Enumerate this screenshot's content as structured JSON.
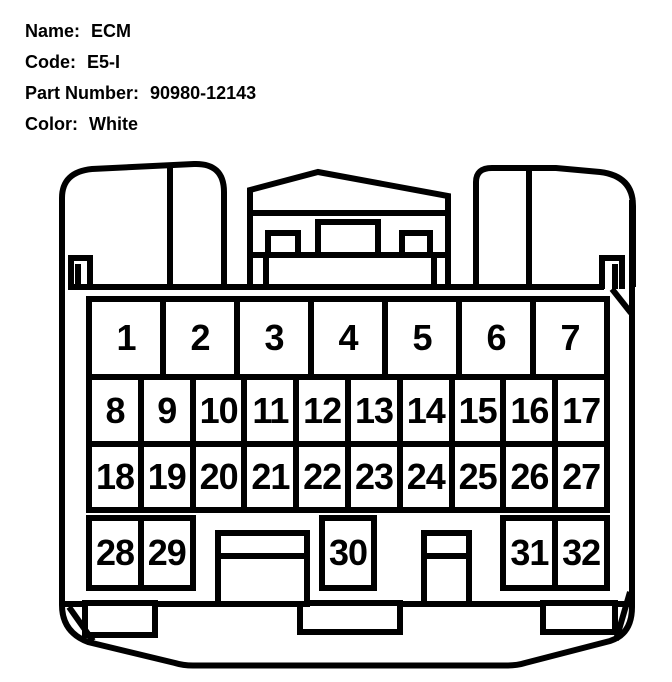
{
  "header": {
    "fields": [
      {
        "key": "name",
        "label": "Name:",
        "value": "ECM"
      },
      {
        "key": "code",
        "label": "Code:",
        "value": "E5-I"
      },
      {
        "key": "part-number",
        "label": "Part Number:",
        "value": "90980-12143"
      },
      {
        "key": "color",
        "label": "Color:",
        "value": "White"
      }
    ]
  },
  "connector": {
    "pin_rows": [
      [
        "1",
        "2",
        "3",
        "4",
        "5",
        "6",
        "7"
      ],
      [
        "8",
        "9",
        "10",
        "11",
        "12",
        "13",
        "14",
        "15",
        "16",
        "17"
      ],
      [
        "18",
        "19",
        "20",
        "21",
        "22",
        "23",
        "24",
        "25",
        "26",
        "27"
      ],
      [
        "28",
        "29",
        "30",
        "31",
        "32"
      ]
    ],
    "line_color": "#000000",
    "body_color": "#ffffff"
  }
}
